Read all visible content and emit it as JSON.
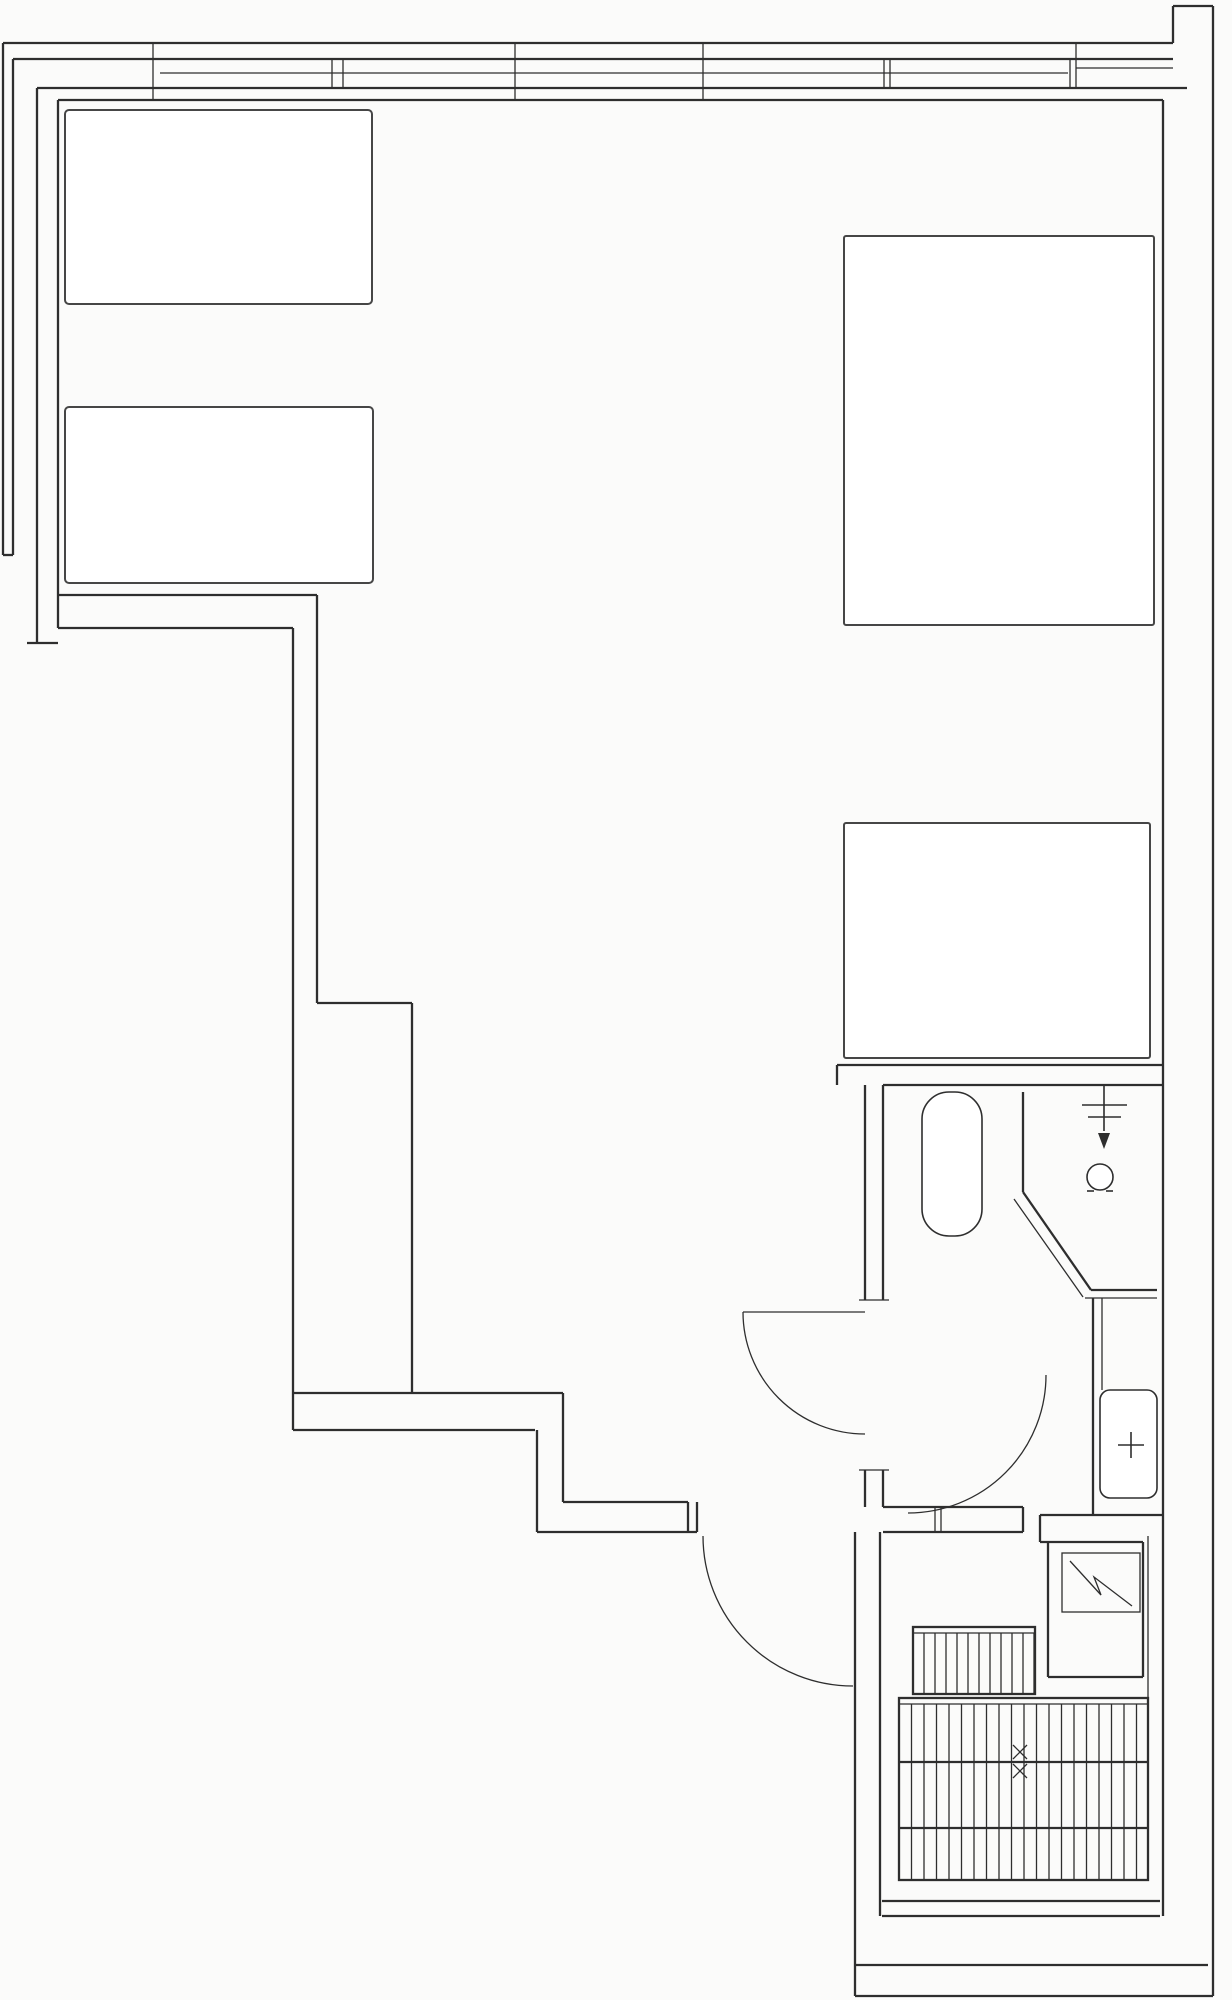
{
  "plan": {
    "type": "architectural-floor-plan",
    "canvas": {
      "width": 1232,
      "height": 2000,
      "background": "#fbfbfa",
      "line_color": "#2e2e2e",
      "furniture_color": "#464646"
    },
    "elements": [
      {
        "name": "window-outer-edge",
        "type": "line",
        "x1": 3,
        "y1": 43,
        "x2": 1173,
        "y2": 43,
        "cls": "wall"
      },
      {
        "name": "window-glass-outer",
        "type": "line",
        "x1": 13,
        "y1": 59,
        "x2": 1173,
        "y2": 59,
        "cls": "wall"
      },
      {
        "name": "window-glass-center",
        "type": "line",
        "x1": 160,
        "y1": 73,
        "x2": 1068,
        "y2": 73,
        "cls": "thin"
      },
      {
        "name": "window-glass-inner",
        "type": "line",
        "x1": 37,
        "y1": 88,
        "x2": 1187,
        "y2": 88,
        "cls": "wall"
      },
      {
        "name": "interior-top-wall",
        "type": "line",
        "x1": 58,
        "y1": 100,
        "x2": 1163,
        "y2": 100,
        "cls": "wall"
      },
      {
        "name": "top-right-notch-side",
        "type": "line",
        "x1": 1173,
        "y1": 6,
        "x2": 1173,
        "y2": 43,
        "cls": "wall"
      },
      {
        "name": "top-right-notch-top",
        "type": "line",
        "x1": 1173,
        "y1": 6,
        "x2": 1213,
        "y2": 6,
        "cls": "wall"
      },
      {
        "name": "right-outer-wall",
        "type": "line",
        "x1": 1213,
        "y1": 6,
        "x2": 1213,
        "y2": 1996,
        "cls": "wall"
      },
      {
        "name": "window-right-return",
        "type": "line",
        "x1": 1076,
        "y1": 68,
        "x2": 1173,
        "y2": 68,
        "cls": "thin"
      },
      {
        "name": "window-mullion-1",
        "type": "line",
        "x1": 153,
        "y1": 43,
        "x2": 153,
        "y2": 100,
        "cls": "thin"
      },
      {
        "name": "window-mullion-2",
        "type": "line",
        "x1": 515,
        "y1": 43,
        "x2": 515,
        "y2": 100,
        "cls": "thin"
      },
      {
        "name": "window-mullion-3",
        "type": "line",
        "x1": 703,
        "y1": 43,
        "x2": 703,
        "y2": 100,
        "cls": "thin"
      },
      {
        "name": "window-joint-1a",
        "type": "line",
        "x1": 332,
        "y1": 59,
        "x2": 332,
        "y2": 88,
        "cls": "thin"
      },
      {
        "name": "window-joint-1b",
        "type": "line",
        "x1": 343,
        "y1": 59,
        "x2": 343,
        "y2": 88,
        "cls": "thin"
      },
      {
        "name": "window-joint-2a",
        "type": "line",
        "x1": 884,
        "y1": 59,
        "x2": 884,
        "y2": 88,
        "cls": "thin"
      },
      {
        "name": "window-joint-2b",
        "type": "line",
        "x1": 890,
        "y1": 59,
        "x2": 890,
        "y2": 88,
        "cls": "thin"
      },
      {
        "name": "window-end-a",
        "type": "line",
        "x1": 1070,
        "y1": 59,
        "x2": 1070,
        "y2": 88,
        "cls": "thin"
      },
      {
        "name": "window-end-b",
        "type": "line",
        "x1": 1076,
        "y1": 43,
        "x2": 1076,
        "y2": 88,
        "cls": "thin"
      },
      {
        "name": "balcony-outer-line",
        "type": "line",
        "x1": 3,
        "y1": 43,
        "x2": 3,
        "y2": 555,
        "cls": "wall"
      },
      {
        "name": "balcony-inner-line",
        "type": "line",
        "x1": 13,
        "y1": 59,
        "x2": 13,
        "y2": 555,
        "cls": "wall"
      },
      {
        "name": "balcony-end-cap",
        "type": "line",
        "x1": 3,
        "y1": 555,
        "x2": 13,
        "y2": 555,
        "cls": "wall"
      },
      {
        "name": "left-wall-outer",
        "type": "line",
        "x1": 37,
        "y1": 88,
        "x2": 37,
        "y2": 643,
        "cls": "wall"
      },
      {
        "name": "left-wall-inner",
        "type": "line",
        "x1": 58,
        "y1": 100,
        "x2": 58,
        "y2": 628,
        "cls": "wall"
      },
      {
        "name": "left-wall-foot",
        "type": "line",
        "x1": 27,
        "y1": 643,
        "x2": 58,
        "y2": 643,
        "cls": "wall"
      },
      {
        "name": "room-divider-upper",
        "type": "line",
        "x1": 58,
        "y1": 595,
        "x2": 317,
        "y2": 595,
        "cls": "wall"
      },
      {
        "name": "room-divider-lower",
        "type": "line",
        "x1": 58,
        "y1": 628,
        "x2": 293,
        "y2": 628,
        "cls": "wall"
      },
      {
        "name": "step-wall-outer-upper",
        "type": "line",
        "x1": 317,
        "y1": 595,
        "x2": 317,
        "y2": 1003,
        "cls": "wall"
      },
      {
        "name": "step-wall-inner",
        "type": "line",
        "x1": 293,
        "y1": 628,
        "x2": 293,
        "y2": 1430,
        "cls": "wall"
      },
      {
        "name": "step-wall-jog",
        "type": "line",
        "x1": 317,
        "y1": 1003,
        "x2": 412,
        "y2": 1003,
        "cls": "wall"
      },
      {
        "name": "step-wall-outer-lower",
        "type": "line",
        "x1": 412,
        "y1": 1003,
        "x2": 412,
        "y2": 1393,
        "cls": "wall"
      },
      {
        "name": "south-wall-outer",
        "type": "line",
        "x1": 293,
        "y1": 1393,
        "x2": 563,
        "y2": 1393,
        "cls": "wall"
      },
      {
        "name": "south-wall-inner",
        "type": "line",
        "x1": 293,
        "y1": 1430,
        "x2": 535,
        "y2": 1430,
        "cls": "wall"
      },
      {
        "name": "south-step-outer",
        "type": "line",
        "x1": 563,
        "y1": 1393,
        "x2": 563,
        "y2": 1502,
        "cls": "wall"
      },
      {
        "name": "south-step-inner",
        "type": "line",
        "x1": 537,
        "y1": 1430,
        "x2": 537,
        "y2": 1532,
        "cls": "wall"
      },
      {
        "name": "entry-wall-outer",
        "type": "line",
        "x1": 563,
        "y1": 1502,
        "x2": 688,
        "y2": 1502,
        "cls": "wall"
      },
      {
        "name": "entry-wall-inner",
        "type": "line",
        "x1": 537,
        "y1": 1532,
        "x2": 697,
        "y2": 1532,
        "cls": "wall"
      },
      {
        "name": "entry-jamb-a",
        "type": "line",
        "x1": 688,
        "y1": 1502,
        "x2": 688,
        "y2": 1532,
        "cls": "wall"
      },
      {
        "name": "entry-jamb-b",
        "type": "line",
        "x1": 697,
        "y1": 1502,
        "x2": 697,
        "y2": 1532,
        "cls": "wall"
      },
      {
        "name": "bath-top-wall-outer",
        "type": "line",
        "x1": 837,
        "y1": 1065,
        "x2": 1163,
        "y2": 1065,
        "cls": "wall"
      },
      {
        "name": "bath-top-wall-inner",
        "type": "line",
        "x1": 883,
        "y1": 1085,
        "x2": 1163,
        "y2": 1085,
        "cls": "wall"
      },
      {
        "name": "bath-top-wall-cap",
        "type": "line",
        "x1": 837,
        "y1": 1065,
        "x2": 837,
        "y2": 1085,
        "cls": "wall"
      },
      {
        "name": "bath-left-wall-a",
        "type": "line",
        "x1": 865,
        "y1": 1085,
        "x2": 865,
        "y2": 1300,
        "cls": "wall"
      },
      {
        "name": "bath-left-wall-b",
        "type": "line",
        "x1": 883,
        "y1": 1085,
        "x2": 883,
        "y2": 1300,
        "cls": "wall"
      },
      {
        "name": "bath-door-jamb-top",
        "type": "line",
        "x1": 859,
        "y1": 1300,
        "x2": 889,
        "y2": 1300,
        "cls": "thin"
      },
      {
        "name": "bath-door-jamb-bottom",
        "type": "line",
        "x1": 859,
        "y1": 1470,
        "x2": 889,
        "y2": 1470,
        "cls": "thin"
      },
      {
        "name": "bath-left-wall-c",
        "type": "line",
        "x1": 865,
        "y1": 1470,
        "x2": 865,
        "y2": 1507,
        "cls": "wall"
      },
      {
        "name": "bath-left-wall-d",
        "type": "line",
        "x1": 883,
        "y1": 1470,
        "x2": 883,
        "y2": 1507,
        "cls": "wall"
      },
      {
        "name": "bath-door-leaf",
        "type": "line",
        "x1": 743,
        "y1": 1312,
        "x2": 865,
        "y2": 1312,
        "cls": "thin"
      },
      {
        "name": "bath-door-swing",
        "type": "path",
        "d": "M 743,1312 A 122,122 0 0 0 865,1434",
        "cls": "thin"
      },
      {
        "name": "shower-divider",
        "type": "line",
        "x1": 1023,
        "y1": 1092,
        "x2": 1023,
        "y2": 1192,
        "cls": "wall"
      },
      {
        "name": "shower-diagonal-a",
        "type": "line",
        "x1": 1023,
        "y1": 1192,
        "x2": 1091,
        "y2": 1290,
        "cls": "wall"
      },
      {
        "name": "shower-diagonal-b",
        "type": "line",
        "x1": 1014,
        "y1": 1199,
        "x2": 1083,
        "y2": 1297,
        "cls": "thin"
      },
      {
        "name": "shower-curb-a",
        "type": "line",
        "x1": 1091,
        "y1": 1290,
        "x2": 1157,
        "y2": 1290,
        "cls": "wall"
      },
      {
        "name": "shower-curb-b",
        "type": "line",
        "x1": 1085,
        "y1": 1298,
        "x2": 1157,
        "y2": 1298,
        "cls": "thin"
      },
      {
        "name": "sink-wall-a",
        "type": "line",
        "x1": 1093,
        "y1": 1298,
        "x2": 1093,
        "y2": 1515,
        "cls": "wall"
      },
      {
        "name": "sink-wall-b",
        "type": "line",
        "x1": 1102,
        "y1": 1298,
        "x2": 1102,
        "y2": 1390,
        "cls": "thin"
      },
      {
        "name": "sink-niche-bottom",
        "type": "line",
        "x1": 1040,
        "y1": 1515,
        "x2": 1163,
        "y2": 1515,
        "cls": "wall"
      },
      {
        "name": "vestibule-band-top",
        "type": "line",
        "x1": 883,
        "y1": 1507,
        "x2": 1023,
        "y2": 1507,
        "cls": "wall"
      },
      {
        "name": "vestibule-band-bottom",
        "type": "line",
        "x1": 883,
        "y1": 1532,
        "x2": 1023,
        "y2": 1532,
        "cls": "wall"
      },
      {
        "name": "vestibule-band-cap",
        "type": "line",
        "x1": 1023,
        "y1": 1507,
        "x2": 1023,
        "y2": 1532,
        "cls": "wall"
      },
      {
        "name": "vestibule-jamb-a",
        "type": "line",
        "x1": 935,
        "y1": 1507,
        "x2": 935,
        "y2": 1532,
        "cls": "thin"
      },
      {
        "name": "vestibule-jamb-b",
        "type": "line",
        "x1": 941,
        "y1": 1507,
        "x2": 941,
        "y2": 1532,
        "cls": "thin"
      },
      {
        "name": "toilet-door-swing",
        "type": "path",
        "d": "M 908,1513 A 138,138 0 0 0 1046,1375",
        "cls": "thin"
      },
      {
        "name": "entry-door-swing",
        "type": "path",
        "d": "M 703,1536 A 150,150 0 0 0 853,1686",
        "cls": "thin"
      },
      {
        "name": "panel-niche-step",
        "type": "line",
        "x1": 1040,
        "y1": 1515,
        "x2": 1040,
        "y2": 1542,
        "cls": "wall"
      },
      {
        "name": "panel-niche-top",
        "type": "line",
        "x1": 1040,
        "y1": 1542,
        "x2": 1143,
        "y2": 1542,
        "cls": "wall"
      },
      {
        "name": "panel-niche-left",
        "type": "line",
        "x1": 1048,
        "y1": 1542,
        "x2": 1048,
        "y2": 1677,
        "cls": "wall"
      },
      {
        "name": "panel-niche-right",
        "type": "line",
        "x1": 1143,
        "y1": 1542,
        "x2": 1143,
        "y2": 1677,
        "cls": "wall"
      },
      {
        "name": "panel-niche-bottom",
        "type": "line",
        "x1": 1048,
        "y1": 1677,
        "x2": 1143,
        "y2": 1677,
        "cls": "wall"
      },
      {
        "name": "stair-wall-left-outer",
        "type": "line",
        "x1": 855,
        "y1": 1532,
        "x2": 855,
        "y2": 1996,
        "cls": "wall"
      },
      {
        "name": "stair-wall-left-inner",
        "type": "line",
        "x1": 880,
        "y1": 1532,
        "x2": 880,
        "y2": 1916,
        "cls": "wall"
      },
      {
        "name": "right-interior-wall",
        "type": "line",
        "x1": 1163,
        "y1": 100,
        "x2": 1163,
        "y2": 1916,
        "cls": "wall"
      },
      {
        "name": "stair-wall-right",
        "type": "line",
        "x1": 1148,
        "y1": 1536,
        "x2": 1148,
        "y2": 1880,
        "cls": "thin"
      },
      {
        "name": "stair-landing-line-a",
        "type": "line",
        "x1": 882,
        "y1": 1901,
        "x2": 1160,
        "y2": 1901,
        "cls": "wall"
      },
      {
        "name": "stair-landing-line-b",
        "type": "line",
        "x1": 882,
        "y1": 1916,
        "x2": 1160,
        "y2": 1916,
        "cls": "wall"
      },
      {
        "name": "bottom-wall-inner",
        "type": "line",
        "x1": 855,
        "y1": 1965,
        "x2": 1208,
        "y2": 1965,
        "cls": "wall"
      },
      {
        "name": "bottom-wall-outer",
        "type": "line",
        "x1": 855,
        "y1": 1996,
        "x2": 1213,
        "y2": 1996,
        "cls": "wall"
      },
      {
        "name": "bed-left-upper",
        "type": "rect",
        "x": 65,
        "y": 110,
        "w": 307,
        "h": 194,
        "r": 4,
        "cls": "furn"
      },
      {
        "name": "bed-left-lower",
        "type": "rect",
        "x": 65,
        "y": 407,
        "w": 308,
        "h": 176,
        "r": 4,
        "cls": "furn"
      },
      {
        "name": "bed-right",
        "type": "rect",
        "x": 844,
        "y": 236,
        "w": 310,
        "h": 389,
        "r": 2,
        "cls": "furn"
      },
      {
        "name": "table-right",
        "type": "rect",
        "x": 844,
        "y": 823,
        "w": 306,
        "h": 235,
        "r": 2,
        "cls": "furn"
      },
      {
        "name": "toilet",
        "type": "rect",
        "x": 922,
        "y": 1092,
        "w": 60,
        "h": 144,
        "r": 27,
        "cls": "fixture"
      },
      {
        "name": "sink",
        "type": "rect",
        "x": 1100,
        "y": 1390,
        "w": 57,
        "h": 108,
        "r": 10,
        "cls": "fixture"
      },
      {
        "name": "electrical-panel",
        "type": "rect",
        "x": 1062,
        "y": 1553,
        "w": 78,
        "h": 59,
        "r": 0,
        "cls": "thin"
      },
      {
        "name": "panel-zigzag",
        "type": "polyline",
        "points": "1070,1561 1101,1595 1094,1577 1132,1606",
        "cls": "thin"
      },
      {
        "name": "stairs-upper-outline",
        "type": "rect",
        "x": 913,
        "y": 1627,
        "w": 122,
        "h": 67,
        "r": 0,
        "cls": "wall"
      },
      {
        "name": "stairs-upper-top-line",
        "type": "line",
        "x1": 913,
        "y1": 1633,
        "x2": 1035,
        "y2": 1633,
        "cls": "thin"
      },
      {
        "name": "stairs-upper-hatch",
        "type": "hatch",
        "x": 913,
        "y": 1633,
        "w": 122,
        "h": 61,
        "step": 11,
        "cls": "thin"
      },
      {
        "name": "stairs-lower-outline",
        "type": "rect",
        "x": 899,
        "y": 1698,
        "w": 249,
        "h": 182,
        "r": 0,
        "cls": "wall"
      },
      {
        "name": "stairs-lower-top-line",
        "type": "line",
        "x1": 899,
        "y1": 1704,
        "x2": 1148,
        "y2": 1704,
        "cls": "thin"
      },
      {
        "name": "stairs-lower-sep-a",
        "type": "line",
        "x1": 899,
        "y1": 1762,
        "x2": 1148,
        "y2": 1762,
        "cls": "wall"
      },
      {
        "name": "stairs-lower-sep-b",
        "type": "line",
        "x1": 899,
        "y1": 1828,
        "x2": 1148,
        "y2": 1828,
        "cls": "wall"
      },
      {
        "name": "stairs-lower-hatch",
        "type": "hatch",
        "x": 899,
        "y": 1704,
        "w": 249,
        "h": 176,
        "step": 12.5,
        "cls": "thin"
      },
      {
        "name": "stair-direction-mark-1",
        "type": "xmark",
        "cx": 1020,
        "cy": 1752,
        "s": 7,
        "cls": "thin"
      },
      {
        "name": "stair-direction-mark-2",
        "type": "xmark",
        "cx": 1020,
        "cy": 1771,
        "s": 7,
        "cls": "thin"
      },
      {
        "name": "shower-head-bar-a",
        "type": "line",
        "x1": 1082,
        "y1": 1105,
        "x2": 1127,
        "y2": 1105,
        "cls": "fixture"
      },
      {
        "name": "shower-head-bar-b",
        "type": "line",
        "x1": 1088,
        "y1": 1117,
        "x2": 1121,
        "y2": 1117,
        "cls": "fixture"
      },
      {
        "name": "shower-pipe",
        "type": "line",
        "x1": 1104,
        "y1": 1085,
        "x2": 1104,
        "y2": 1131,
        "cls": "fixture"
      },
      {
        "name": "shower-arrow",
        "type": "polygon",
        "points": "1098,1133 1110,1133 1104,1149",
        "cls": "solid"
      },
      {
        "name": "shower-drain",
        "type": "circle",
        "cx": 1100,
        "cy": 1177,
        "r": 13,
        "cls": "fixture"
      },
      {
        "name": "shower-drain-foot-a",
        "type": "line",
        "x1": 1087,
        "y1": 1191,
        "x2": 1094,
        "y2": 1191,
        "cls": "fixture"
      },
      {
        "name": "shower-drain-foot-b",
        "type": "line",
        "x1": 1106,
        "y1": 1191,
        "x2": 1113,
        "y2": 1191,
        "cls": "fixture"
      },
      {
        "name": "sink-faucet-h",
        "type": "line",
        "x1": 1118,
        "y1": 1445,
        "x2": 1144,
        "y2": 1445,
        "cls": "fixture"
      },
      {
        "name": "sink-faucet-v",
        "type": "line",
        "x1": 1131,
        "y1": 1432,
        "x2": 1131,
        "y2": 1458,
        "cls": "fixture"
      }
    ]
  }
}
